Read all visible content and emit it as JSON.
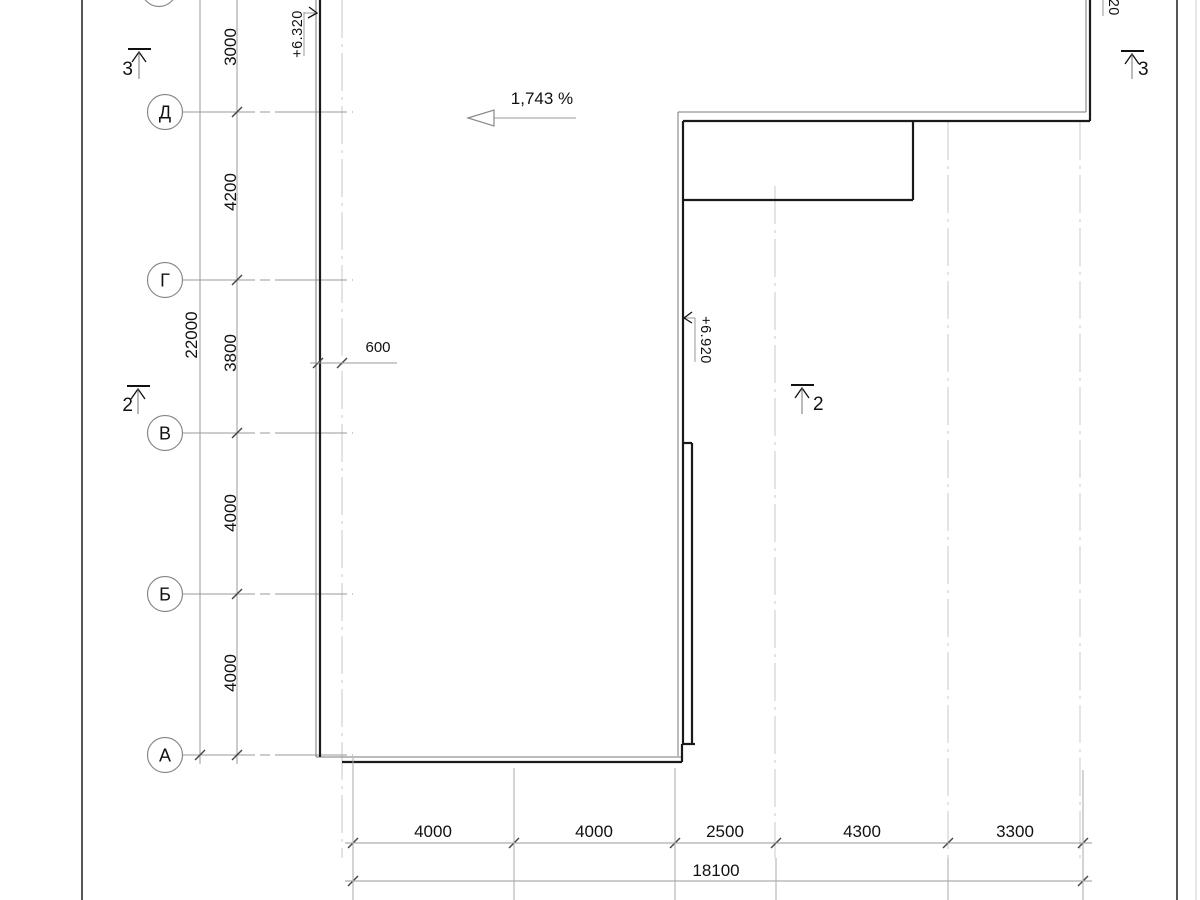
{
  "drawing": {
    "title_hint": "roof-plan-fragment",
    "slope": {
      "label": "1,743 %"
    },
    "axis_rows": {
      "labels": [
        "Д",
        "Г",
        "В",
        "Б",
        "А"
      ]
    },
    "vertical_dims": {
      "segments": [
        "3000",
        "4200",
        "3800",
        "4000",
        "4000"
      ],
      "overall": "22000"
    },
    "horizontal_dims": {
      "segments": [
        "4000",
        "4000",
        "2500",
        "4300",
        "3300"
      ],
      "overall": "18100"
    },
    "offset_dim": {
      "label": "600"
    },
    "elevation_marks": {
      "top_left": "+6.320",
      "middle": "+6.920",
      "top_right": "+6.920"
    },
    "section_markers": {
      "left_top": "3",
      "right_top": "3",
      "left_mid": "2",
      "right_mid": "2"
    },
    "colors": {
      "outline_thick": "#1a1a1a",
      "outline_thin": "#7a7a7a",
      "dimension_lines": "#999999",
      "grid_dashed": "#c9c9c9",
      "text": "#111111",
      "background": "#ffffff"
    }
  }
}
